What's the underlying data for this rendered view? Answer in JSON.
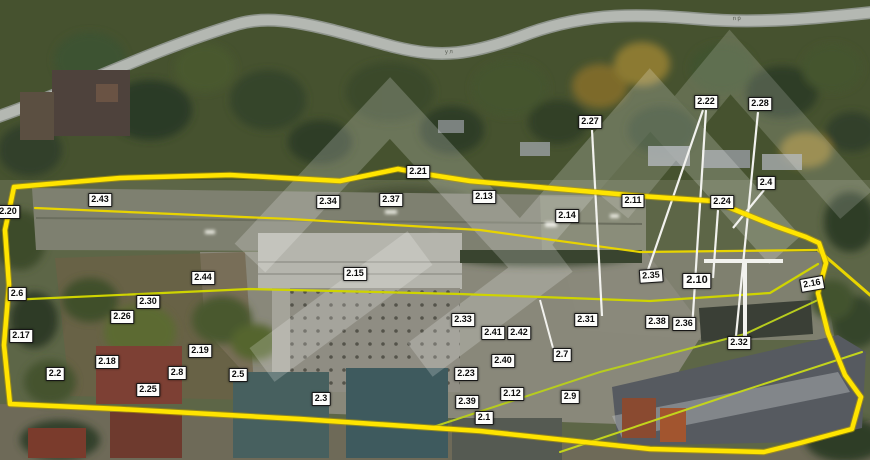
{
  "map": {
    "type": "satellite-site-plan",
    "boundary_color": "#ffe400",
    "inner_line_color": "#cfd400",
    "leader_line_color": "#f2f2ee",
    "label_background": "#fdfdfb",
    "label_text_color": "#0c0c0c",
    "watermark": "chevron-zigzag-pattern",
    "streets": {
      "left_road_text": "ская ул",
      "top_road_text": "ул",
      "right_road_text": "пр"
    }
  },
  "labels": [
    {
      "t": "2.20",
      "x": 8,
      "y": 212
    },
    {
      "t": "2.43",
      "x": 100,
      "y": 200
    },
    {
      "t": "2.21",
      "x": 418,
      "y": 172
    },
    {
      "t": "2.34",
      "x": 328,
      "y": 202
    },
    {
      "t": "2.37",
      "x": 391,
      "y": 200
    },
    {
      "t": "2.13",
      "x": 484,
      "y": 197
    },
    {
      "t": "2.14",
      "x": 567,
      "y": 216
    },
    {
      "t": "2.11",
      "x": 633,
      "y": 201
    },
    {
      "t": "2.24",
      "x": 722,
      "y": 202
    },
    {
      "t": "2.27",
      "x": 590,
      "y": 122
    },
    {
      "t": "2.22",
      "x": 706,
      "y": 102
    },
    {
      "t": "2.28",
      "x": 760,
      "y": 104
    },
    {
      "t": "2.4",
      "x": 766,
      "y": 183
    },
    {
      "t": "2.44",
      "x": 203,
      "y": 278
    },
    {
      "t": "2.15",
      "x": 355,
      "y": 274
    },
    {
      "t": "2.6",
      "x": 17,
      "y": 294
    },
    {
      "t": "2.30",
      "x": 148,
      "y": 302
    },
    {
      "t": "2.26",
      "x": 122,
      "y": 317
    },
    {
      "t": "2.17",
      "x": 21,
      "y": 336
    },
    {
      "t": "2.2",
      "x": 55,
      "y": 374
    },
    {
      "t": "2.18",
      "x": 107,
      "y": 362
    },
    {
      "t": "2.25",
      "x": 148,
      "y": 390
    },
    {
      "t": "2.19",
      "x": 200,
      "y": 351
    },
    {
      "t": "2.8",
      "x": 177,
      "y": 373
    },
    {
      "t": "2.5",
      "x": 238,
      "y": 375
    },
    {
      "t": "2.3",
      "x": 321,
      "y": 399
    },
    {
      "t": "2.33",
      "x": 463,
      "y": 320
    },
    {
      "t": "2.41",
      "x": 493,
      "y": 333
    },
    {
      "t": "2.42",
      "x": 519,
      "y": 333
    },
    {
      "t": "2.23",
      "x": 466,
      "y": 374
    },
    {
      "t": "2.39",
      "x": 467,
      "y": 402
    },
    {
      "t": "2.1",
      "x": 484,
      "y": 418
    },
    {
      "t": "2.12",
      "x": 512,
      "y": 394
    },
    {
      "t": "2.40",
      "x": 503,
      "y": 361
    },
    {
      "t": "2.7",
      "x": 562,
      "y": 355
    },
    {
      "t": "2.9",
      "x": 570,
      "y": 397
    },
    {
      "t": "2.31",
      "x": 586,
      "y": 320
    },
    {
      "t": "2.35",
      "x": 651,
      "y": 276,
      "r": -4
    },
    {
      "t": "2.10",
      "x": 697,
      "y": 281,
      "big": true
    },
    {
      "t": "2.38",
      "x": 657,
      "y": 322
    },
    {
      "t": "2.36",
      "x": 684,
      "y": 324
    },
    {
      "t": "2.32",
      "x": 739,
      "y": 343
    },
    {
      "t": "2.16",
      "x": 812,
      "y": 284,
      "r": -10
    }
  ]
}
